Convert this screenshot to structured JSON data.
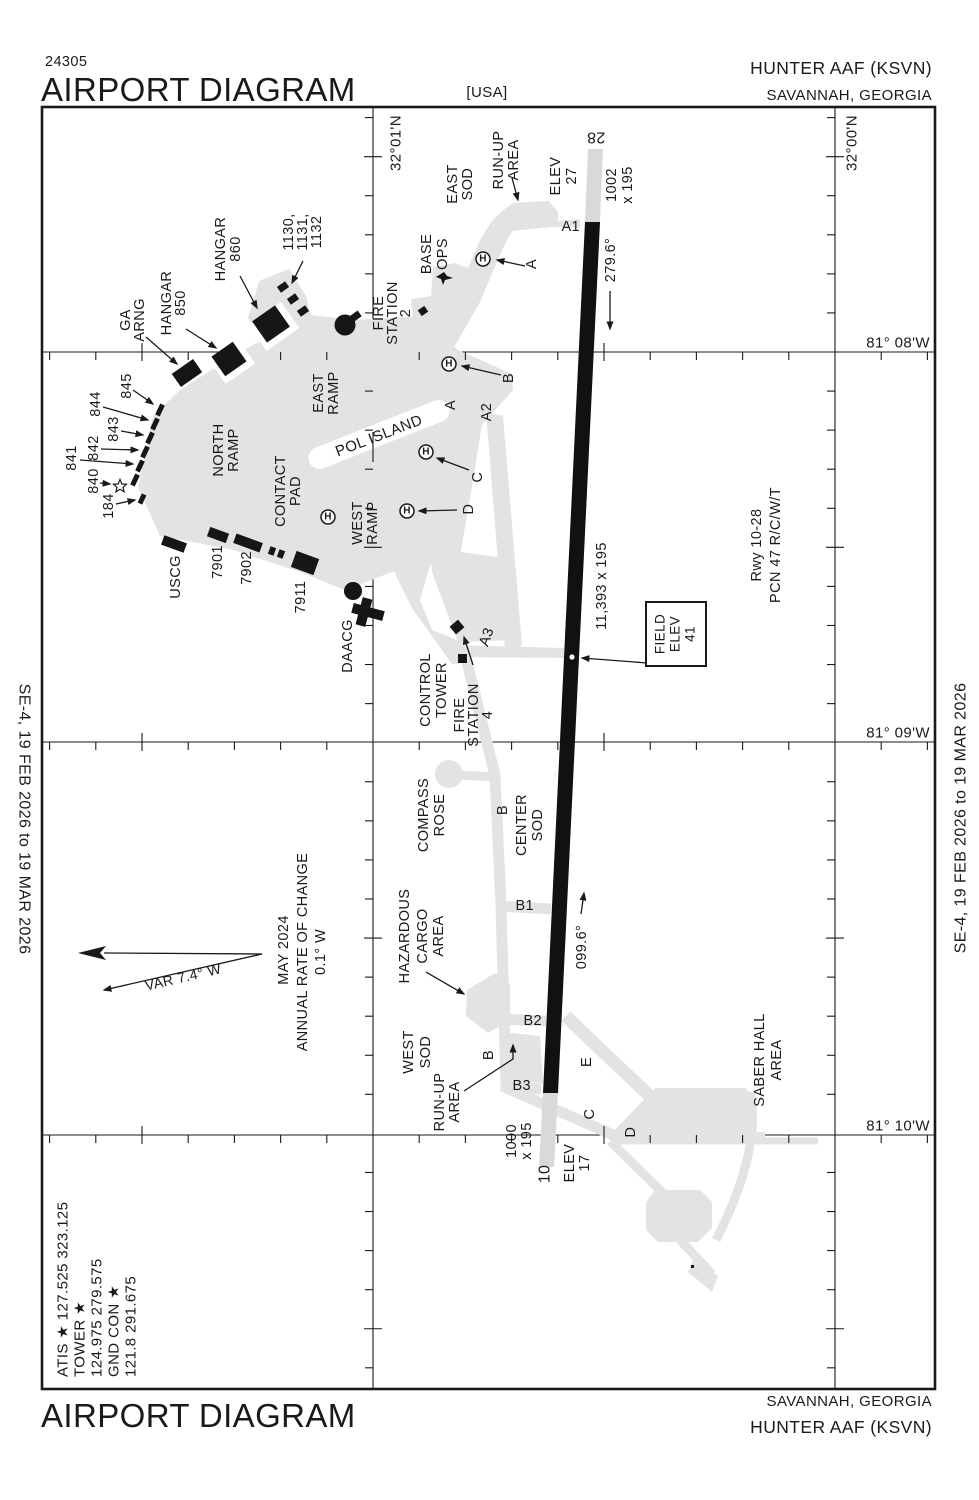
{
  "header": {
    "chart_number": "24305",
    "title": "AIRPORT DIAGRAM",
    "country": "[USA]",
    "airport": "HUNTER AAF   (KSVN)",
    "city": "SAVANNAH, GEORGIA"
  },
  "footer": {
    "title": "AIRPORT DIAGRAM",
    "city": "SAVANNAH, GEORGIA",
    "airport": "HUNTER AAF   (KSVN)"
  },
  "margins": {
    "left_date": "SE-4,   19 FEB 2026   to   19 MAR 2026",
    "right_date": "SE-4,   19 FEB 2026   to   19 MAR 2026"
  },
  "symbols": {
    "helipad": "H"
  },
  "colors": {
    "apron": "#e3e3e3",
    "overrun": "#d9d9d9",
    "ink": "#1a1a1a"
  },
  "runway": {
    "id": "10-28",
    "length_width": "11,393 x 195",
    "pcn": "PCN 47 R/C/W/T",
    "hdg_28": "279.6°",
    "hdg_10": "099.6°",
    "elev_28": 27,
    "elev_10": 17,
    "field_elev": 41,
    "overrun_28": "1002 x 195",
    "overrun_10": "1000 x 195"
  },
  "labels": [
    {
      "n": "lat-label-3201",
      "t": "32°01'N",
      "x": 396,
      "y": 143,
      "r": -90,
      "s": 15
    },
    {
      "n": "lat-label-3200",
      "t": "32°00'N",
      "x": 852,
      "y": 143,
      "r": -90,
      "s": 15
    },
    {
      "n": "lon-label-8108",
      "t": "81° 08'W",
      "x": 930,
      "y": 343,
      "r": 0,
      "s": 15,
      "a": "end"
    },
    {
      "n": "lon-label-8109",
      "t": "81° 09'W",
      "x": 930,
      "y": 733,
      "r": 0,
      "s": 15,
      "a": "end"
    },
    {
      "n": "lon-label-8110",
      "t": "81° 10'W",
      "x": 930,
      "y": 1126,
      "r": 0,
      "s": 15,
      "a": "end"
    },
    {
      "n": "rwy-28-number",
      "t": "28",
      "x": 596,
      "y": 137,
      "r": 180,
      "s": 16
    },
    {
      "n": "rwy-10-number",
      "t": "10",
      "x": 545,
      "y": 1174,
      "r": -90,
      "s": 16
    },
    {
      "n": "rwy-28-elev-1",
      "t": "ELEV",
      "x": 556,
      "y": 176,
      "r": -90
    },
    {
      "n": "rwy-28-elev-2",
      "t": "27",
      "x": 572,
      "y": 176,
      "r": -90
    },
    {
      "n": "rwy-28-overrun-1",
      "t": "1002",
      "x": 612,
      "y": 185,
      "r": -90
    },
    {
      "n": "rwy-28-overrun-2",
      "t": "x 195",
      "x": 628,
      "y": 185,
      "r": -90
    },
    {
      "n": "rwy-28-heading",
      "t": "279.6°",
      "x": 611,
      "y": 260,
      "r": -90
    },
    {
      "n": "rwy-10-heading",
      "t": "099.6°",
      "x": 582,
      "y": 947,
      "r": -90
    },
    {
      "n": "rwy-dimensions",
      "t": "11,393 x 195",
      "x": 602,
      "y": 586,
      "r": -90
    },
    {
      "n": "rwy-info-1",
      "t": "Rwy 10-28",
      "x": 757,
      "y": 545,
      "r": -90
    },
    {
      "n": "rwy-info-2",
      "t": "PCN 47 R/C/W/T",
      "x": 776,
      "y": 545,
      "r": -90
    },
    {
      "n": "rwy-10-overrun-1",
      "t": "1000",
      "x": 512,
      "y": 1141,
      "r": -90
    },
    {
      "n": "rwy-10-overrun-2",
      "t": "x 195",
      "x": 527,
      "y": 1141,
      "r": -90
    },
    {
      "n": "rwy-10-elev-1",
      "t": "ELEV",
      "x": 570,
      "y": 1163,
      "r": -90
    },
    {
      "n": "rwy-10-elev-2",
      "t": "17",
      "x": 585,
      "y": 1163,
      "r": -90
    },
    {
      "n": "field-elev-1",
      "t": "FIELD",
      "x": 660,
      "y": 634,
      "r": -90,
      "s": 13.5
    },
    {
      "n": "field-elev-2",
      "t": "ELEV",
      "x": 675,
      "y": 634,
      "r": -90,
      "s": 13.5
    },
    {
      "n": "field-elev-3",
      "t": "41",
      "x": 690,
      "y": 634,
      "r": -90,
      "s": 13.5
    },
    {
      "n": "taxiway-a1",
      "t": "A1",
      "x": 580,
      "y": 227,
      "r": 0,
      "a": "end"
    },
    {
      "n": "taxiway-a-north",
      "t": "A",
      "x": 532,
      "y": 264,
      "r": -90
    },
    {
      "n": "taxiway-b-north",
      "t": "B",
      "x": 509,
      "y": 378,
      "r": -90
    },
    {
      "n": "taxiway-a-mid",
      "t": "A",
      "x": 451,
      "y": 405,
      "r": -90
    },
    {
      "n": "taxiway-a2",
      "t": "A2",
      "x": 487,
      "y": 412,
      "r": -90
    },
    {
      "n": "taxiway-c-mid",
      "t": "C",
      "x": 478,
      "y": 477,
      "r": -90
    },
    {
      "n": "taxiway-d-mid",
      "t": "D",
      "x": 469,
      "y": 509,
      "r": -90
    },
    {
      "n": "taxiway-a3",
      "t": "A3",
      "x": 487,
      "y": 637,
      "r": -70
    },
    {
      "n": "taxiway-b-mid",
      "t": "B",
      "x": 503,
      "y": 810,
      "r": -90
    },
    {
      "n": "taxiway-b1",
      "t": "B1",
      "x": 534,
      "y": 906,
      "r": 0,
      "a": "end"
    },
    {
      "n": "taxiway-b2",
      "t": "B2",
      "x": 542,
      "y": 1021,
      "r": 0,
      "a": "end"
    },
    {
      "n": "taxiway-b3",
      "t": "B3",
      "x": 531,
      "y": 1086,
      "r": 0,
      "a": "end"
    },
    {
      "n": "taxiway-b-south",
      "t": "B",
      "x": 489,
      "y": 1055,
      "r": -90
    },
    {
      "n": "taxiway-e",
      "t": "E",
      "x": 587,
      "y": 1062,
      "r": -90
    },
    {
      "n": "taxiway-c-south",
      "t": "C",
      "x": 590,
      "y": 1114,
      "r": -90
    },
    {
      "n": "taxiway-d-south",
      "t": "D",
      "x": 631,
      "y": 1132,
      "r": -90
    },
    {
      "n": "east-sod-1",
      "t": "EAST",
      "x": 453,
      "y": 184,
      "r": -90
    },
    {
      "n": "east-sod-2",
      "t": "SOD",
      "x": 468,
      "y": 184,
      "r": -90
    },
    {
      "n": "runup-north-1",
      "t": "RUN-UP",
      "x": 499,
      "y": 160,
      "r": -90
    },
    {
      "n": "runup-north-2",
      "t": "AREA",
      "x": 514,
      "y": 160,
      "r": -90
    },
    {
      "n": "base-ops-1",
      "t": "BASE",
      "x": 427,
      "y": 254,
      "r": -90
    },
    {
      "n": "base-ops-2",
      "t": "OPS",
      "x": 443,
      "y": 254,
      "r": -90
    },
    {
      "n": "fire-station2-1",
      "t": "FIRE",
      "x": 379,
      "y": 313,
      "r": -90
    },
    {
      "n": "fire-station2-2",
      "t": "STATION",
      "x": 393,
      "y": 313,
      "r": -90
    },
    {
      "n": "fire-station2-3",
      "t": "2",
      "x": 406,
      "y": 313,
      "r": -90
    },
    {
      "n": "east-ramp-1",
      "t": "EAST",
      "x": 319,
      "y": 393,
      "r": -90
    },
    {
      "n": "east-ramp-2",
      "t": "RAMP",
      "x": 334,
      "y": 393,
      "r": -90
    },
    {
      "n": "north-ramp-1",
      "t": "NORTH",
      "x": 219,
      "y": 450,
      "r": -90
    },
    {
      "n": "north-ramp-2",
      "t": "RAMP",
      "x": 234,
      "y": 450,
      "r": -90
    },
    {
      "n": "contact-pad-1",
      "t": "CONTACT",
      "x": 281,
      "y": 491,
      "r": -90
    },
    {
      "n": "contact-pad-2",
      "t": "PAD",
      "x": 296,
      "y": 491,
      "r": -90
    },
    {
      "n": "west-ramp-1",
      "t": "WEST",
      "x": 358,
      "y": 523,
      "r": -90
    },
    {
      "n": "west-ramp-2",
      "t": "RAMP",
      "x": 373,
      "y": 523,
      "r": -90
    },
    {
      "n": "pol-island",
      "t": "POL ISLAND",
      "x": 379,
      "y": 436,
      "r": -21,
      "s": 15
    },
    {
      "n": "hangar-850-1",
      "t": "HANGAR",
      "x": 167,
      "y": 303,
      "r": -90
    },
    {
      "n": "hangar-850-2",
      "t": "850",
      "x": 181,
      "y": 303,
      "r": -90
    },
    {
      "n": "hangar-860-1",
      "t": "HANGAR",
      "x": 221,
      "y": 249,
      "r": -90
    },
    {
      "n": "hangar-860-2",
      "t": "860",
      "x": 236,
      "y": 249,
      "r": -90
    },
    {
      "n": "ga-arng-1",
      "t": "GA",
      "x": 126,
      "y": 320,
      "r": -90
    },
    {
      "n": "ga-arng-2",
      "t": "ARNG",
      "x": 140,
      "y": 320,
      "r": -90
    },
    {
      "n": "bldg-1130-1",
      "t": "1130,",
      "x": 289,
      "y": 232,
      "r": -90
    },
    {
      "n": "bldg-1130-2",
      "t": "1131,",
      "x": 303,
      "y": 232,
      "r": -90
    },
    {
      "n": "bldg-1130-3",
      "t": "1132",
      "x": 317,
      "y": 232,
      "r": -90
    },
    {
      "n": "bldg-845",
      "t": "845",
      "x": 127,
      "y": 386,
      "r": -90
    },
    {
      "n": "bldg-844",
      "t": "844",
      "x": 96,
      "y": 404,
      "r": -90
    },
    {
      "n": "bldg-843",
      "t": "843",
      "x": 114,
      "y": 429,
      "r": -90
    },
    {
      "n": "bldg-842",
      "t": "842",
      "x": 94,
      "y": 448,
      "r": -90
    },
    {
      "n": "bldg-841",
      "t": "841",
      "x": 72,
      "y": 458,
      "r": -90
    },
    {
      "n": "bldg-840",
      "t": "840",
      "x": 94,
      "y": 481,
      "r": -90
    },
    {
      "n": "bldg-184",
      "t": "184",
      "x": 109,
      "y": 506,
      "r": -90
    },
    {
      "n": "bldg-uscg",
      "t": "USCG",
      "x": 176,
      "y": 577,
      "r": -90
    },
    {
      "n": "bldg-7901",
      "t": "7901",
      "x": 218,
      "y": 562,
      "r": -90
    },
    {
      "n": "bldg-7902",
      "t": "7902",
      "x": 247,
      "y": 568,
      "r": -90
    },
    {
      "n": "bldg-7911",
      "t": "7911",
      "x": 301,
      "y": 597,
      "r": -90
    },
    {
      "n": "bldg-daacg",
      "t": "DAACG",
      "x": 348,
      "y": 646,
      "r": -90
    },
    {
      "n": "control-tower-1",
      "t": "CONTROL",
      "x": 426,
      "y": 690,
      "r": -90
    },
    {
      "n": "control-tower-2",
      "t": "TOWER",
      "x": 442,
      "y": 690,
      "r": -90
    },
    {
      "n": "fire-station4-1",
      "t": "FIRE",
      "x": 460,
      "y": 715,
      "r": -90
    },
    {
      "n": "fire-station4-2",
      "t": "STATION",
      "x": 474,
      "y": 715,
      "r": -90
    },
    {
      "n": "fire-station4-3",
      "t": "4",
      "x": 488,
      "y": 715,
      "r": -90
    },
    {
      "n": "compass-rose-1",
      "t": "COMPASS",
      "x": 424,
      "y": 815,
      "r": -90
    },
    {
      "n": "compass-rose-2",
      "t": "ROSE",
      "x": 440,
      "y": 815,
      "r": -90
    },
    {
      "n": "center-sod-1",
      "t": "CENTER",
      "x": 522,
      "y": 825,
      "r": -90
    },
    {
      "n": "center-sod-2",
      "t": "SOD",
      "x": 538,
      "y": 825,
      "r": -90
    },
    {
      "n": "hazardous-1",
      "t": "HAZARDOUS",
      "x": 405,
      "y": 936,
      "r": -90
    },
    {
      "n": "hazardous-2",
      "t": "CARGO",
      "x": 423,
      "y": 936,
      "r": -90
    },
    {
      "n": "hazardous-3",
      "t": "AREA",
      "x": 439,
      "y": 936,
      "r": -90
    },
    {
      "n": "west-sod-1",
      "t": "WEST",
      "x": 409,
      "y": 1052,
      "r": -90
    },
    {
      "n": "west-sod-2",
      "t": "SOD",
      "x": 426,
      "y": 1052,
      "r": -90
    },
    {
      "n": "runup-south-1",
      "t": "RUN-UP",
      "x": 440,
      "y": 1102,
      "r": -90
    },
    {
      "n": "runup-south-2",
      "t": "AREA",
      "x": 455,
      "y": 1102,
      "r": -90
    },
    {
      "n": "saber-hall-1",
      "t": "SABER HALL",
      "x": 760,
      "y": 1060,
      "r": -90
    },
    {
      "n": "saber-hall-2",
      "t": "AREA",
      "x": 777,
      "y": 1060,
      "r": -90
    },
    {
      "n": "var-label",
      "t": "VAR 7.4° W",
      "x": 183,
      "y": 977,
      "r": -13,
      "s": 14
    },
    {
      "n": "var-date",
      "t": "MAY 2024",
      "x": 284,
      "y": 950,
      "r": -90
    },
    {
      "n": "var-rate-1",
      "t": "ANNUAL RATE OF CHANGE",
      "x": 303,
      "y": 952,
      "r": -90
    },
    {
      "n": "var-rate-2",
      "t": "0.1° W",
      "x": 321,
      "y": 952,
      "r": -90
    },
    {
      "n": "freq-atis",
      "t": "ATIS ★ 127.525  323.125",
      "x": 63,
      "y": 1377,
      "r": -90,
      "s": 15,
      "a": "start"
    },
    {
      "n": "freq-tower",
      "t": "TOWER ★",
      "x": 80,
      "y": 1377,
      "r": -90,
      "s": 15,
      "a": "start"
    },
    {
      "n": "freq-tower-values",
      "t": "124.975  279.575",
      "x": 97,
      "y": 1377,
      "r": -90,
      "s": 15,
      "a": "start"
    },
    {
      "n": "freq-gnd-con",
      "t": "GND CON ★",
      "x": 114,
      "y": 1377,
      "r": -90,
      "s": 15,
      "a": "start"
    },
    {
      "n": "freq-gnd-values",
      "t": "121.8  291.675",
      "x": 131,
      "y": 1377,
      "r": -90,
      "s": 15,
      "a": "start"
    },
    {
      "n": "margin-left-date",
      "t": "SE-4,   19 FEB 2026   to   19 MAR 2026",
      "x": 24,
      "y": 819,
      "r": 90,
      "s": 16,
      "ls": 1.5
    },
    {
      "n": "margin-right-date",
      "t": "SE-4,   19 FEB 2026   to   19 MAR 2026",
      "x": 961,
      "y": 818,
      "r": -90,
      "s": 16,
      "ls": 1.5
    }
  ]
}
